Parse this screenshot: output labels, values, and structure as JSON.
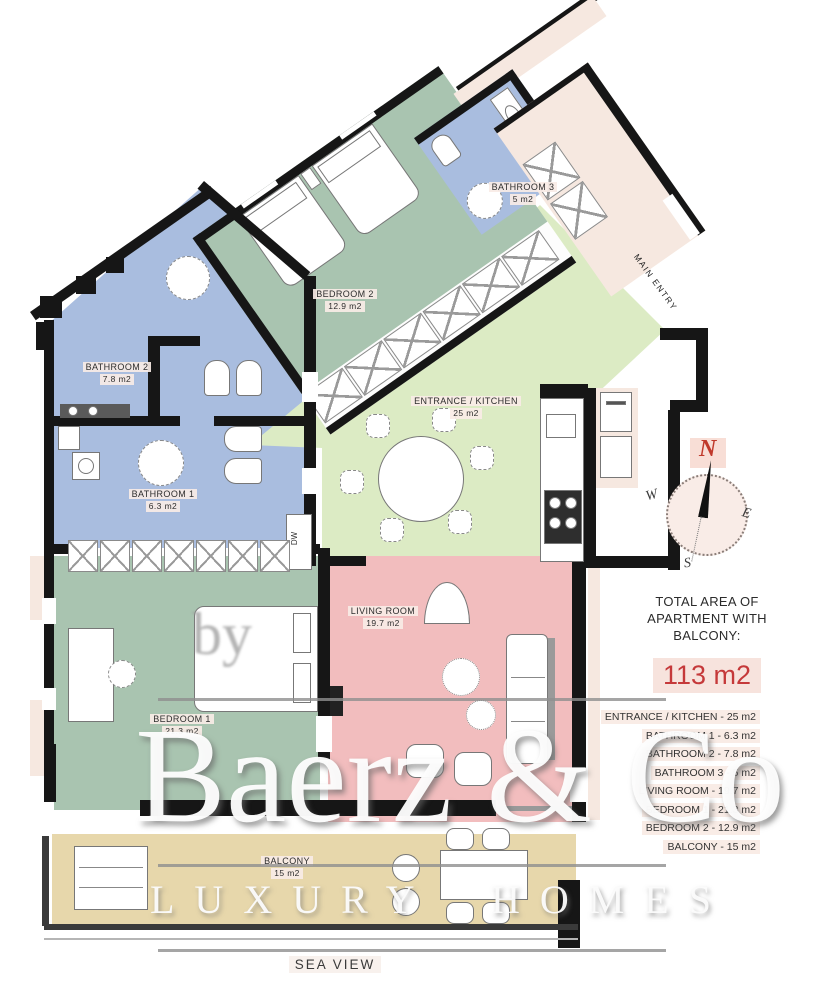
{
  "plan": {
    "rooms": [
      {
        "name": "BEDROOM 2",
        "area": "12.9 m2"
      },
      {
        "name": "BATHROOM 3",
        "area": "5 m2"
      },
      {
        "name": "BATHROOM 2",
        "area": "7.8 m2"
      },
      {
        "name": "BATHROOM 1",
        "area": "6.3 m2"
      },
      {
        "name": "ENTRANCE / KITCHEN",
        "area": "25 m2"
      },
      {
        "name": "LIVING ROOM",
        "area": "19.7 m2"
      },
      {
        "name": "BEDROOM 1",
        "area": "21.3 m2"
      },
      {
        "name": "BALCONY",
        "area": "15 m2"
      }
    ],
    "labels": {
      "main_entry": "MAIN ENTRY",
      "sea_view": "SEA VIEW",
      "dishwasher": "DW"
    }
  },
  "compass": {
    "n": "N",
    "w": "W",
    "e": "E",
    "s": "S"
  },
  "summary": {
    "title": "TOTAL AREA OF APARTMENT WITH BALCONY:",
    "total": "113 m2",
    "items": [
      "ENTRANCE / KITCHEN - 25 m2",
      "BATHROOM 1 - 6.3 m2",
      "BATHROOM 2 - 7.8 m2",
      "BATHROOM 3 - 5 m2",
      "LIVING ROOM - 19.7 m2",
      "BEDROOM 1 - 21.3 m2",
      "BEDROOM 2 - 12.9 m2",
      "BALCONY - 15 m2"
    ]
  },
  "watermark": {
    "by": "by",
    "brand": "Baerz & Co",
    "tagline": "LUXURY HOMES"
  },
  "colors": {
    "bedroom": "#a9c4b0",
    "bathroom": "#a9bddf",
    "kitchen": "#dcebc4",
    "living": "#f2bdbe",
    "balcony": "#e7d7ab",
    "exterior": "#f6e8e0",
    "accent_red": "#c5393a"
  }
}
